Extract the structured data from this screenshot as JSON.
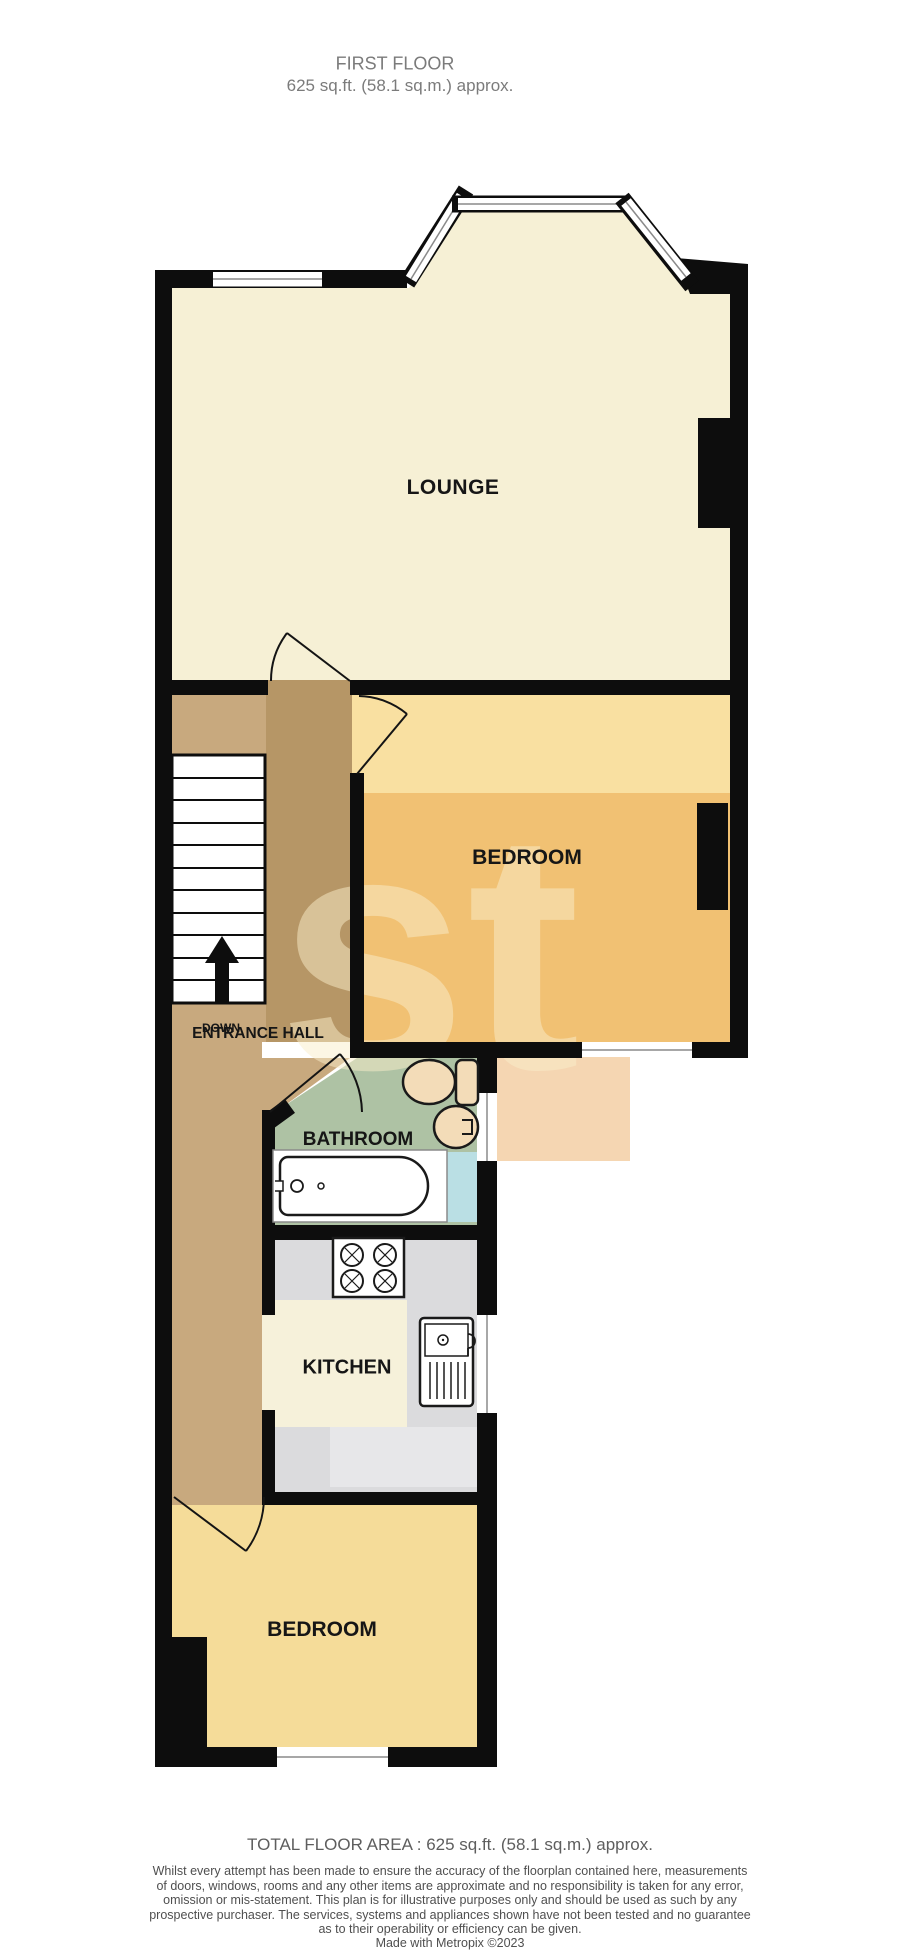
{
  "header": {
    "line1": "FIRST FLOOR",
    "line2": "625 sq.ft. (58.1 sq.m.) approx."
  },
  "rooms": {
    "lounge": "LOUNGE",
    "bedroom_middle": "BEDROOM",
    "entrance_hall": "ENTRANCE HALL",
    "stairs_direction": "DOWN",
    "bathroom": "BATHROOM",
    "kitchen": "KITCHEN",
    "bedroom_bottom": "BEDROOM"
  },
  "watermark": {
    "text": "st"
  },
  "footer": {
    "total_area": "TOTAL FLOOR AREA : 625 sq.ft. (58.1 sq.m.) approx.",
    "disclaimer": [
      "Whilst every attempt has been made to ensure the accuracy of the floorplan contained here, measurements",
      "of doors, windows, rooms and any other items are approximate and no responsibility is taken for any error,",
      "omission or mis-statement. This plan is for illustrative purposes only and should be used as such by any",
      "prospective purchaser. The services, systems and appliances shown have not been tested and no guarantee",
      "as to their operability or efficiency can be given."
    ],
    "credit": "Made with Metropix ©2023"
  },
  "colors": {
    "wall": "#0d0d0d",
    "lounge_floor": "#f6f0d5",
    "bedroom_floor_light": "#f9e0a1",
    "hall_floor": "#c8a97e",
    "bathroom_floor": "#aec2a4",
    "tub_area_blue": "#badfe4",
    "kitchen_floor": "#dbdbdd",
    "kitchen_counter": "#f6f1da",
    "kitchen_floor_light": "#e7e7e9",
    "bedroom2_floor": "#f5dc99",
    "fixture_fill": "#f3dcb8",
    "window_line": "#8a8a8a",
    "watermark_cream": "#faeecb"
  }
}
